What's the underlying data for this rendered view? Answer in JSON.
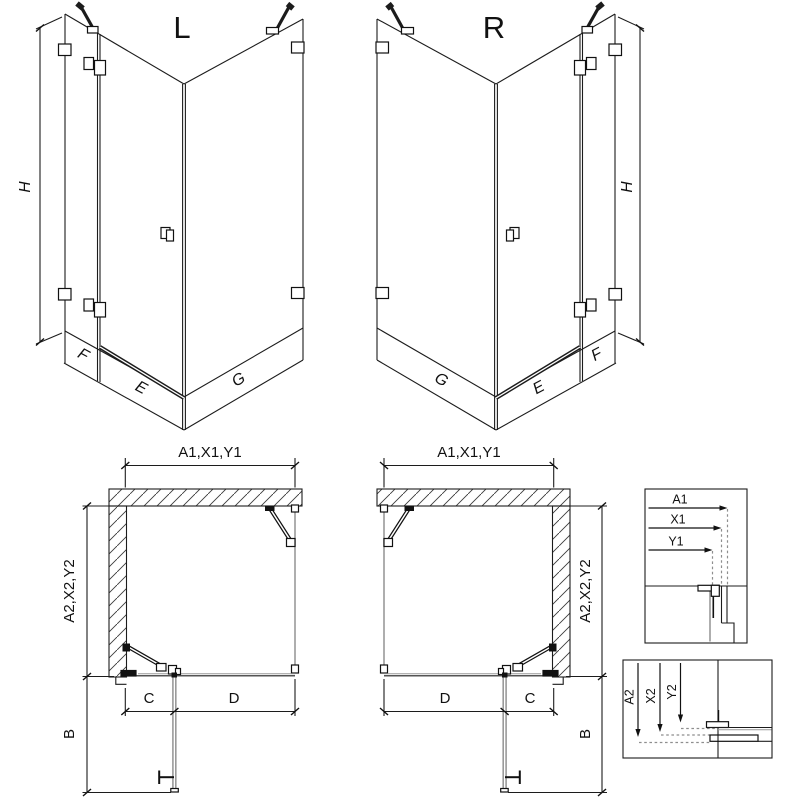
{
  "figure": {
    "type": "shower-enclosure-technical-diagram",
    "background": "#ffffff",
    "line_color": "#1c1c1c",
    "glass_line_color": "#9a9a9a",
    "views": {
      "iso_left": {
        "variant_label": "L",
        "height_label": "H",
        "fixed_label": "F",
        "door_label": "E",
        "side_label": "G"
      },
      "iso_right": {
        "variant_label": "R",
        "height_label": "H",
        "fixed_label": "F",
        "door_label": "E",
        "side_label": "G"
      },
      "plan_left": {
        "top_dim": "A1,X1,Y1",
        "side_dim": "A2,X2,Y2",
        "swing_dim": "B",
        "c_dim": "C",
        "d_dim": "D"
      },
      "plan_right": {
        "top_dim": "A1,X1,Y1",
        "side_dim": "A2,X2,Y2",
        "swing_dim": "B",
        "c_dim": "C",
        "d_dim": "D"
      },
      "detail_top": {
        "a1": "A1",
        "x1": "X1",
        "y1": "Y1"
      },
      "detail_bottom": {
        "a2": "A2",
        "x2": "X2",
        "y2": "Y2"
      }
    }
  }
}
